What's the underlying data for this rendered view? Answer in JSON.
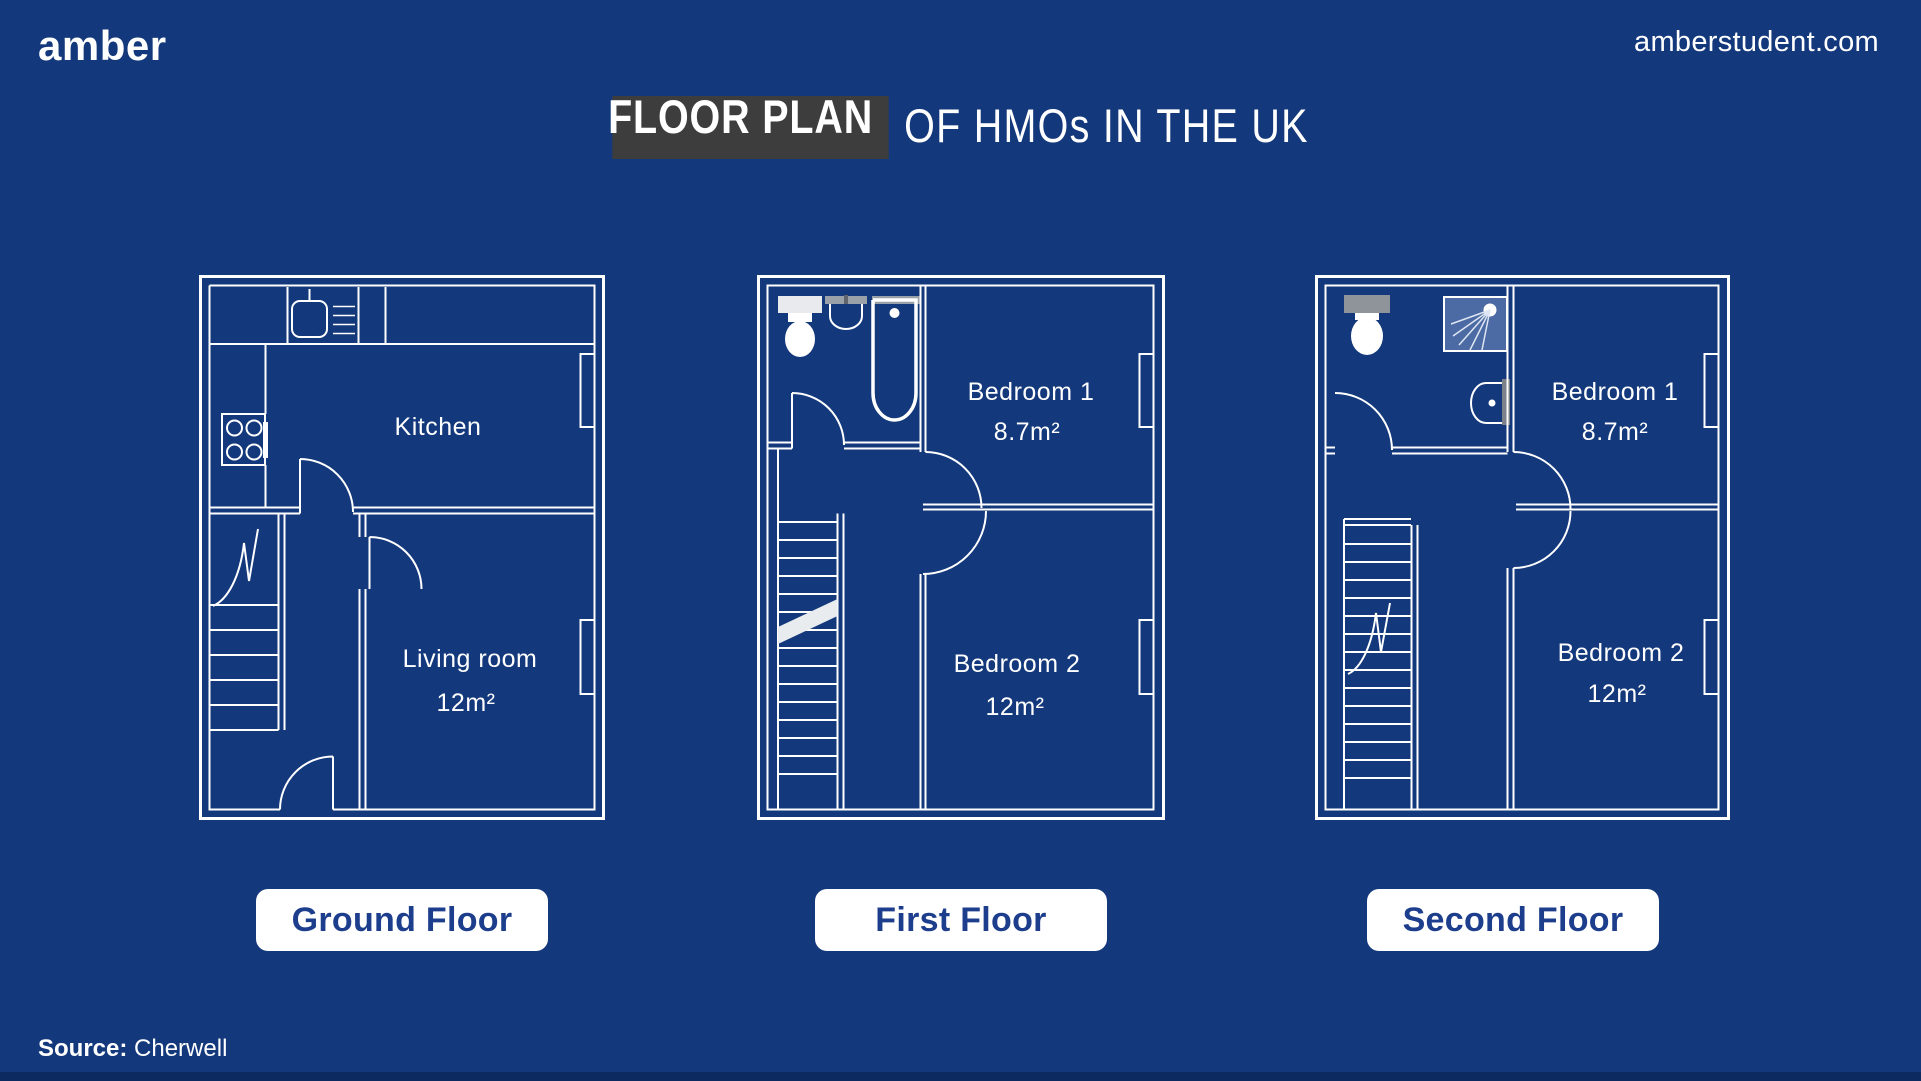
{
  "header": {
    "logo": "amber",
    "website": "amberstudent.com"
  },
  "title": {
    "highlight": "FLOOR PLAN",
    "rest": "OF HMOs IN THE UK"
  },
  "floors": [
    {
      "label": "Ground Floor",
      "rooms": [
        {
          "name": "Kitchen"
        },
        {
          "name": "Living room",
          "area": "12m²"
        }
      ]
    },
    {
      "label": "First Floor",
      "rooms": [
        {
          "name": "Bedroom 1",
          "area": "8.7m²"
        },
        {
          "name": "Bedroom 2",
          "area": "12m²"
        }
      ]
    },
    {
      "label": "Second Floor",
      "rooms": [
        {
          "name": "Bedroom 1",
          "area": "8.7m²"
        },
        {
          "name": "Bedroom 2",
          "area": "12m²"
        }
      ]
    }
  ],
  "source": {
    "label": "Source:",
    "value": "Cherwell"
  },
  "colors": {
    "background": "#13387b",
    "footer_strip": "#0c2a5f",
    "title_highlight_box": "#3d3d3d",
    "button_text": "#1d3e8c",
    "wall_white": "#ffffff",
    "shower_blue": "#4c6ba4",
    "fixture_gray": "#9ba1a9"
  }
}
